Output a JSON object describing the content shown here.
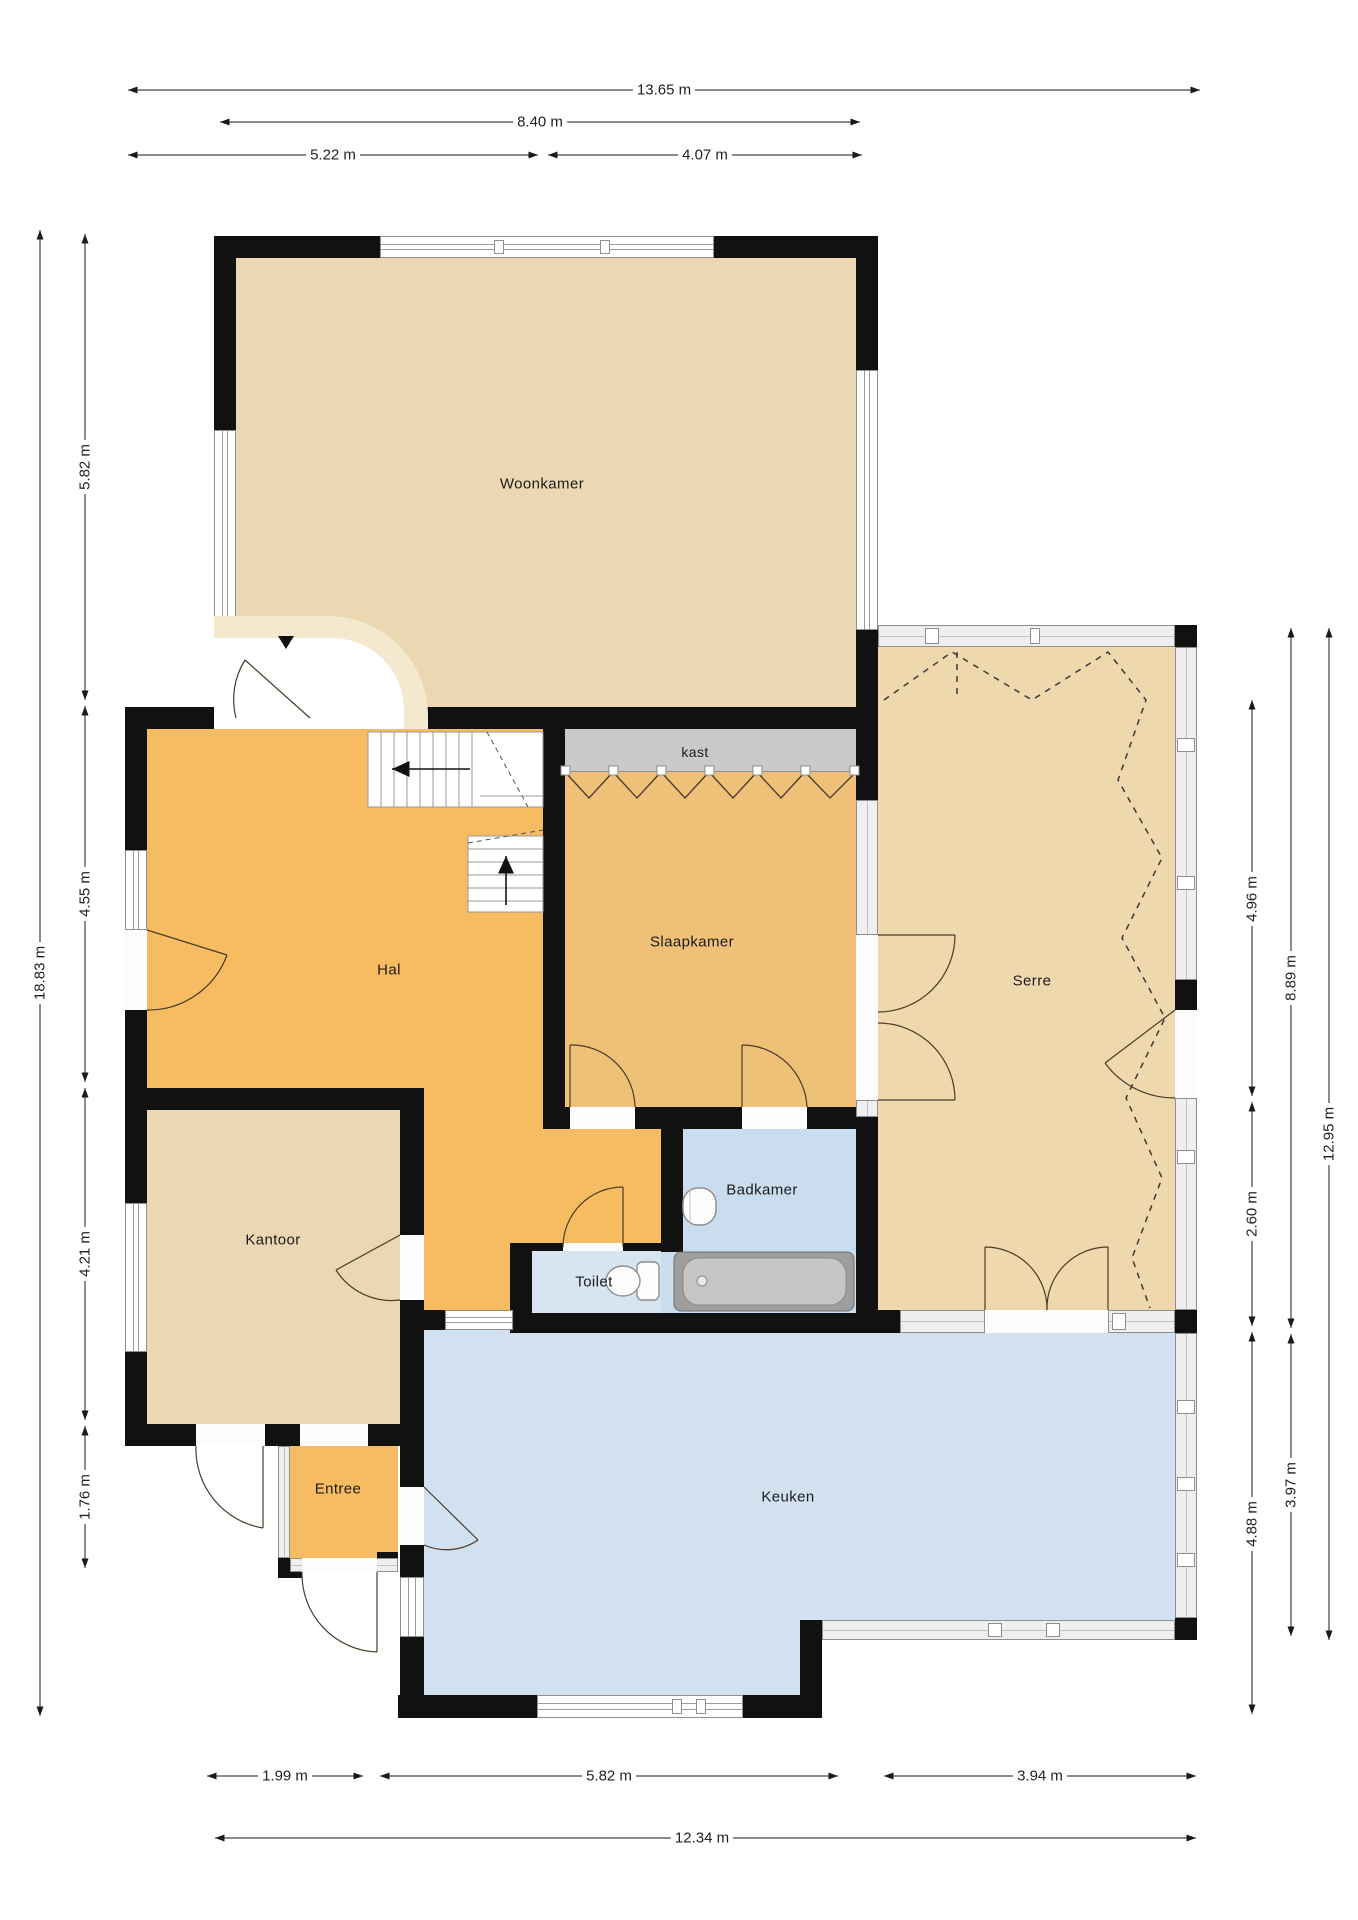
{
  "rooms": {
    "woonkamer": "Woonkamer",
    "hal": "Hal",
    "kantoor": "Kantoor",
    "entree": "Entree",
    "toilet": "Toilet",
    "badkamer": "Badkamer",
    "slaapkamer": "Slaapkamer",
    "serre": "Serre",
    "keuken": "Keuken",
    "kast": "kast"
  },
  "dimensions": {
    "top": [
      "13.65 m",
      "8.40 m",
      "5.22 m",
      "4.07 m"
    ],
    "left": [
      "18.83 m",
      "5.82 m",
      "4.55 m",
      "4.21 m",
      "1.76 m"
    ],
    "right": [
      "4.96 m",
      "2.60 m",
      "4.88 m",
      "8.89 m",
      "3.97 m",
      "12.95 m"
    ],
    "bottom": [
      "1.99 m",
      "5.82 m",
      "3.94 m",
      "12.34 m"
    ]
  },
  "colors": {
    "woonkamer": "#EBD7B1",
    "kantoor": "#EBD7B1",
    "serre": "#F0D8AE",
    "hal": "#F7BB61",
    "entree": "#F7BB61",
    "slaapkamer": "#EFC078",
    "keuken": "#D2E1EF",
    "badkamer": "#C9DDEE",
    "toilet": "#D7E5F2",
    "kast": "#C9C9C9",
    "wall": "#111111"
  }
}
